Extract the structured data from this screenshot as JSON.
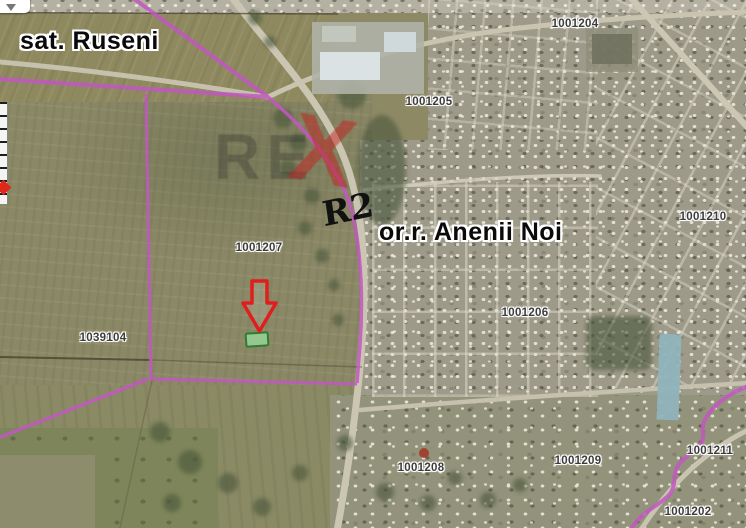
{
  "map_labels": {
    "village": "sat. Ruseni",
    "town": "or.r. Anenii Noi",
    "road_ref": "R2"
  },
  "parcels": [
    {
      "id": "1001204",
      "x": 575,
      "y": 24
    },
    {
      "id": "1001205",
      "x": 429,
      "y": 102
    },
    {
      "id": "1001207",
      "x": 259,
      "y": 248
    },
    {
      "id": "1039104",
      "x": 103,
      "y": 338
    },
    {
      "id": "1001206",
      "x": 525,
      "y": 313
    },
    {
      "id": "1001208",
      "x": 421,
      "y": 468
    },
    {
      "id": "1001209",
      "x": 578,
      "y": 461
    },
    {
      "id": "1001210",
      "x": 703,
      "y": 217
    },
    {
      "id": "1001211",
      "x": 710,
      "y": 451
    },
    {
      "id": "1001202",
      "x": 688,
      "y": 512
    }
  ],
  "target_marker": {
    "arrow_color": "#e01e1e",
    "plot_fill": "#94c890",
    "plot_stroke": "#2f7c33"
  },
  "watermark": {
    "text": "RE",
    "accent": "X"
  },
  "boundary_color": "#c257c2"
}
